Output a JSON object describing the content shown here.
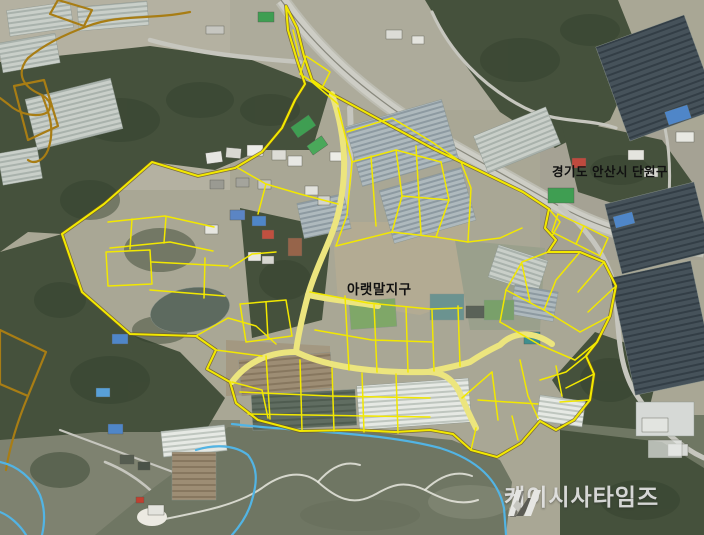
{
  "map": {
    "region_label": "경기도 안산시 단원구",
    "district_label": "아랫말지구",
    "watermark_text": "케이시사타임즈",
    "colors": {
      "parcel_outline": "#f2e800",
      "parcel_road_fill": "#ece57e",
      "boundary_orange": "#a87d14",
      "stream_blue": "#52b4e4",
      "label_text": "#111111",
      "watermark_text": "#e3e3e3",
      "forest": "#45513c",
      "river": "#6f7663",
      "road": "#cdcdc5"
    }
  }
}
